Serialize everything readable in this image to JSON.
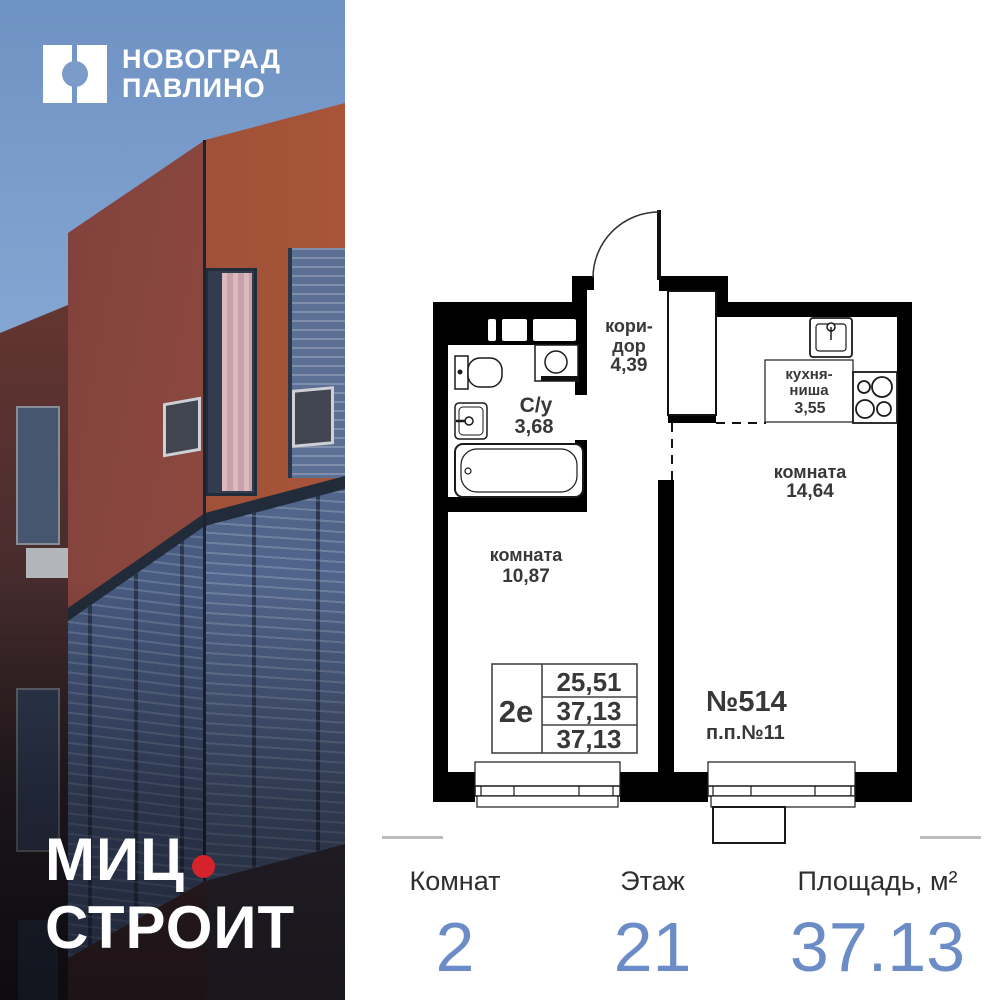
{
  "brand": {
    "icon": "split-square-with-circle",
    "project_name_line1": "НОВОГРАД",
    "project_name_line2": "ПАВЛИНО",
    "developer_line1": "МИЦ",
    "developer_line2": "СТРОИТ"
  },
  "floor_plan": {
    "corridor": {
      "name_line1": "кори-",
      "name_line2": "дор",
      "area": "4,39"
    },
    "bathroom": {
      "name": "С/у",
      "area": "3,68"
    },
    "kitchen": {
      "name_line1": "кухня-",
      "name_line2": "ниша",
      "area": "3,55"
    },
    "room_small": {
      "name": "комната",
      "area": "10,87"
    },
    "room_large": {
      "name": "комната",
      "area": "14,64"
    },
    "apartment_number": "№514",
    "project_position": "п.п.№11",
    "type_table": {
      "type": "2е",
      "rows": [
        "25,51",
        "37,13",
        "37,13"
      ]
    }
  },
  "stats": {
    "rooms": {
      "label": "Комнат",
      "value": "2"
    },
    "floor": {
      "label": "Этаж",
      "value": "21"
    },
    "area": {
      "label": "Площадь, м²",
      "value": "37.13"
    }
  },
  "colors": {
    "accent_blue": "#6b8cc6",
    "red_dot": "#d6222a",
    "wall_black": "#000000",
    "sky_blue": "#7092c2",
    "facade_red": "#a85539",
    "facade_glazing": "#4c5f85"
  }
}
